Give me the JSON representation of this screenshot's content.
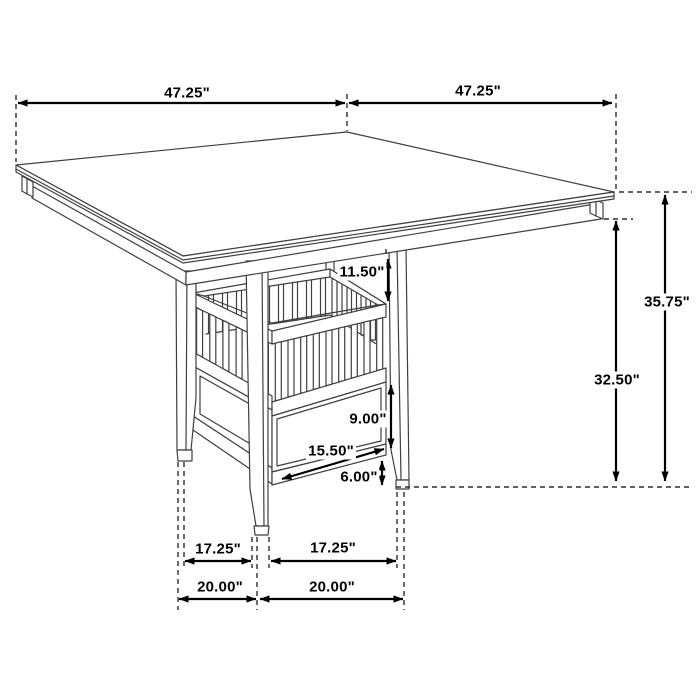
{
  "diagram": {
    "subject": "counter-height square dining table with slatted storage basket and drawer pedestal",
    "view": "perspective line drawing with dimension annotations",
    "unit": "inches",
    "background_color": "#ffffff",
    "drawing_line_color": "#3f3f3f",
    "dimension_line_color": "#000000"
  },
  "dimensions": {
    "tabletop_width_left": "47.25\"",
    "tabletop_width_right": "47.25\"",
    "overall_height": "35.75\"",
    "underside_height": "32.50\"",
    "basket_inset_depth": "11.50\"",
    "drawer_section_height": "9.00\"",
    "drawer_width": "15.50\"",
    "base_clearance": "6.00\"",
    "leg_clear_span_left": "17.25\"",
    "leg_clear_span_right": "17.25\"",
    "leg_outer_span_left": "20.00\"",
    "leg_outer_span_right": "20.00\""
  }
}
